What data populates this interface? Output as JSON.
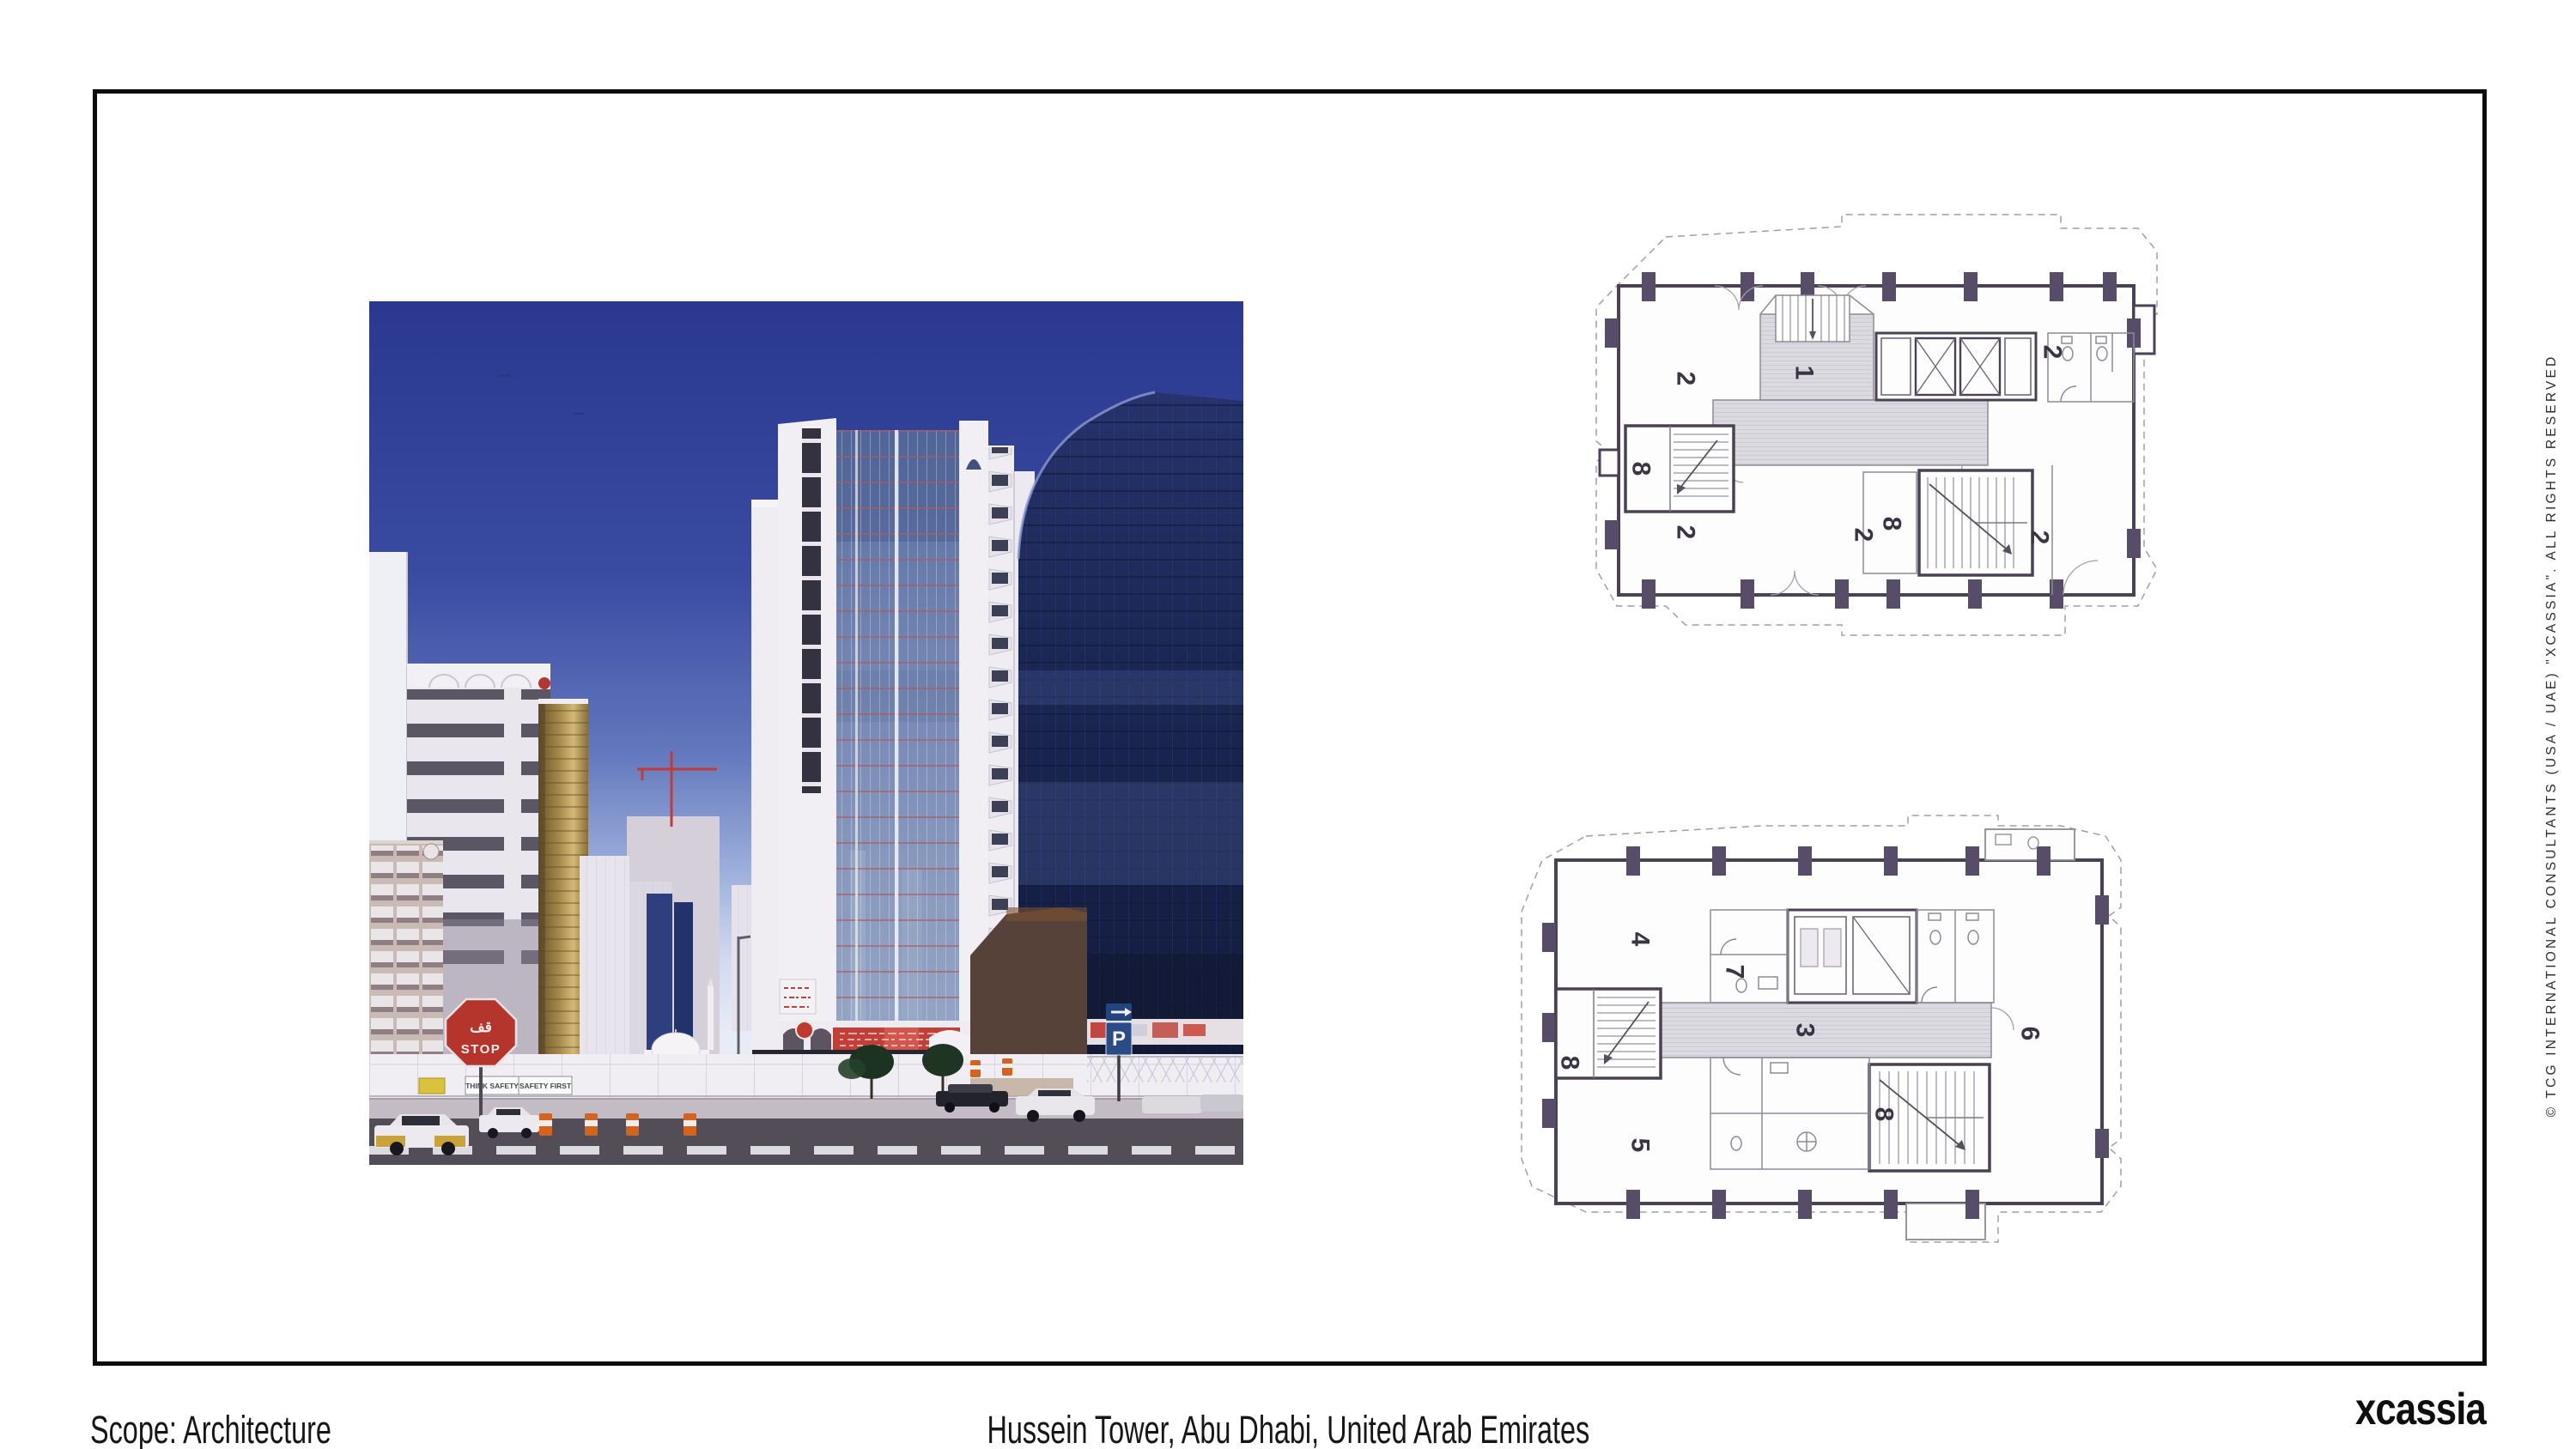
{
  "footer": {
    "scope": "Scope: Architecture",
    "title": "Hussein Tower, Abu Dhabi, United Arab Emirates",
    "logo": "xcassia"
  },
  "copyright_vertical": "© TCG INTERNATIONAL CONSULTANTS (USA / UAE) \"XCASSIA\". ALL RIGHTS RESERVED",
  "photo": {
    "description": "Street-level photograph of Hussein Tower and surrounding high-rises, Abu Dhabi",
    "signs": {
      "stop_arabic": "قف",
      "stop_english": "STOP",
      "fence_banner_left": "THINK SAFETY",
      "fence_banner_right": "SAFETY FIRST",
      "federal_sign": "FEDERAL",
      "parking_letter": "P"
    },
    "colors": {
      "sky_top": "#2a388f",
      "sky_horizon": "#e8ecf7",
      "tower_white": "#f1eff4",
      "curtain_glass": "#7789b4",
      "dark_glass": "#1b2753",
      "gold_glass": "#a3874a",
      "stop_red": "#b5342c"
    }
  },
  "plans": {
    "upper": {
      "rooms": [
        "2",
        "2",
        "1",
        "8",
        "8",
        "2",
        "2",
        "2"
      ]
    },
    "lower": {
      "rooms": [
        "4",
        "7",
        "3",
        "6",
        "5",
        "8",
        "8"
      ]
    }
  }
}
